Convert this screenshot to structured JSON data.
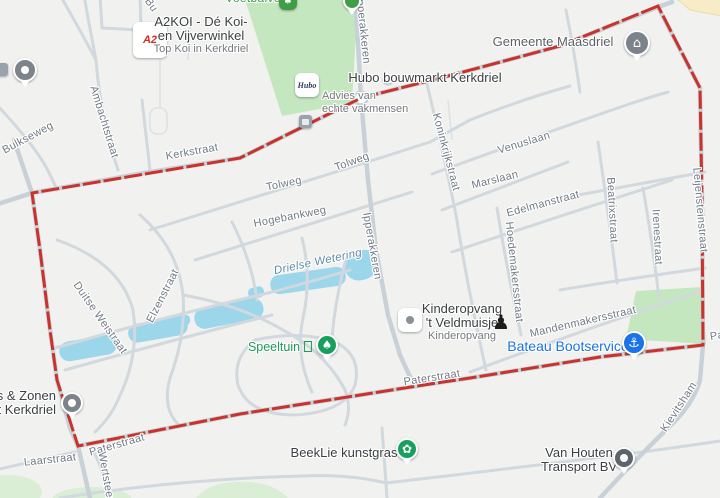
{
  "colors": {
    "bg": "#f1f2ef",
    "road_major": "#c9d1d8",
    "road_minor": "#d1d8de",
    "road_faint": "#dde2e6",
    "water": "#9cd6ea",
    "park": "#c4e7c0",
    "park_pale": "#d9eed4",
    "yellow_area": "#f6ecc8",
    "boundary": "#c9271e",
    "street_label": "#717a85",
    "water_label": "#5f8ca8",
    "park_label": "#3e9c47",
    "poi_dark": "#3c4043",
    "poi_sub": "#75797e",
    "poi_green": "#1d9a57",
    "poi_blue": "#1a73e8",
    "pin_green": "#17a05d",
    "pin_blue": "#1a73e8",
    "pin_gray": "#7c838b"
  },
  "street_labels": [
    {
      "text": "Kerkstraat",
      "x": 192,
      "y": 152,
      "rot": -10,
      "style": "road"
    },
    {
      "text": "Tolweg",
      "x": 284,
      "y": 184,
      "rot": -12,
      "style": "road"
    },
    {
      "text": "Tolweg",
      "x": 352,
      "y": 162,
      "rot": -20,
      "style": "road"
    },
    {
      "text": "Hogebankweg",
      "x": 290,
      "y": 217,
      "rot": -11,
      "style": "road"
    },
    {
      "text": "Drielse Wetering",
      "x": 318,
      "y": 262,
      "rot": -12,
      "style": "water"
    },
    {
      "text": "Ipperakkeren",
      "x": 363,
      "y": 30,
      "rot": 84,
      "style": "road"
    },
    {
      "text": "Ipperakkeren",
      "x": 372,
      "y": 246,
      "rot": 80,
      "style": "road"
    },
    {
      "text": "Koninkrijkstraat",
      "x": 446,
      "y": 152,
      "rot": 75,
      "style": "road"
    },
    {
      "text": "Venuslaan",
      "x": 524,
      "y": 143,
      "rot": -17,
      "style": "road"
    },
    {
      "text": "Marslaan",
      "x": 495,
      "y": 180,
      "rot": -14,
      "style": "road"
    },
    {
      "text": "Edelmanstraat",
      "x": 543,
      "y": 204,
      "rot": -15,
      "style": "road"
    },
    {
      "text": "Hoedemakersstraat",
      "x": 514,
      "y": 272,
      "rot": 84,
      "style": "road"
    },
    {
      "text": "Beatrixstraat",
      "x": 612,
      "y": 210,
      "rot": 87,
      "style": "road"
    },
    {
      "text": "Irenestraat",
      "x": 657,
      "y": 237,
      "rot": 87,
      "style": "road"
    },
    {
      "text": "Leijensteinstraat",
      "x": 700,
      "y": 210,
      "rot": 85,
      "style": "road"
    },
    {
      "text": "Mandenmakersstraat",
      "x": 583,
      "y": 322,
      "rot": -13,
      "style": "road"
    },
    {
      "text": "Paterstraat",
      "x": 432,
      "y": 378,
      "rot": -9,
      "style": "road"
    },
    {
      "text": "Paterstraat",
      "x": 117,
      "y": 445,
      "rot": -16,
      "style": "road"
    },
    {
      "text": "Pa",
      "x": 717,
      "y": 336,
      "rot": -10,
      "style": "road"
    },
    {
      "text": "Laarstraat",
      "x": 50,
      "y": 460,
      "rot": -6,
      "style": "road"
    },
    {
      "text": "Wertsteeg",
      "x": 106,
      "y": 478,
      "rot": 80,
      "style": "road"
    },
    {
      "text": "Duitse Weistraat",
      "x": 100,
      "y": 318,
      "rot": 55,
      "style": "road"
    },
    {
      "text": "Elzenstraat",
      "x": 163,
      "y": 296,
      "rot": -63,
      "style": "road"
    },
    {
      "text": "Ambachtstraat",
      "x": 104,
      "y": 122,
      "rot": 73,
      "style": "road"
    },
    {
      "text": "Bulkseweg",
      "x": 28,
      "y": 138,
      "rot": -28,
      "style": "road"
    },
    {
      "text": "Kievitsham",
      "x": 679,
      "y": 407,
      "rot": -57,
      "style": "road"
    },
    {
      "text": "Bu",
      "x": 151,
      "y": 5,
      "rot": 55,
      "style": "road"
    }
  ],
  "pois": {
    "voetbal": {
      "title": "Voetbalveld"
    },
    "a2koi": {
      "line1": "A2KOI - Dé Koi-",
      "line2": "en Vijverwinkel",
      "sub": "Top Koi in Kerkdriel",
      "logo": "A2"
    },
    "hubo": {
      "title": "Hubo bouwmarkt Kerkdriel",
      "sub1": "Advies van",
      "sub2": "echte vakmensen",
      "logo": "Hubo"
    },
    "gemeente": {
      "title": "Gemeente Maasdriel"
    },
    "kinderopvang": {
      "line1": "Kinderopvang",
      "line2": "'t Veldmuisje",
      "sub": "Kinderopvang"
    },
    "speeltuin": {
      "title": "Speeltuin"
    },
    "bateau": {
      "title": "Bateau Bootservice"
    },
    "beeklie": {
      "title": "BeekLie kunstgras"
    },
    "vanhouten": {
      "line1": "Van Houten",
      "line2": "Transport BV"
    },
    "zonen": {
      "line1": "os & Zonen",
      "line2": "rt Kerkdriel"
    }
  },
  "icons": {
    "gemeente_glyph": "⌂",
    "speeltuin_glyph": "♠",
    "bateau_glyph": "⚓",
    "beeklie_glyph": "✿",
    "pawn_glyph": "♟",
    "tree_glyph": "♠"
  }
}
